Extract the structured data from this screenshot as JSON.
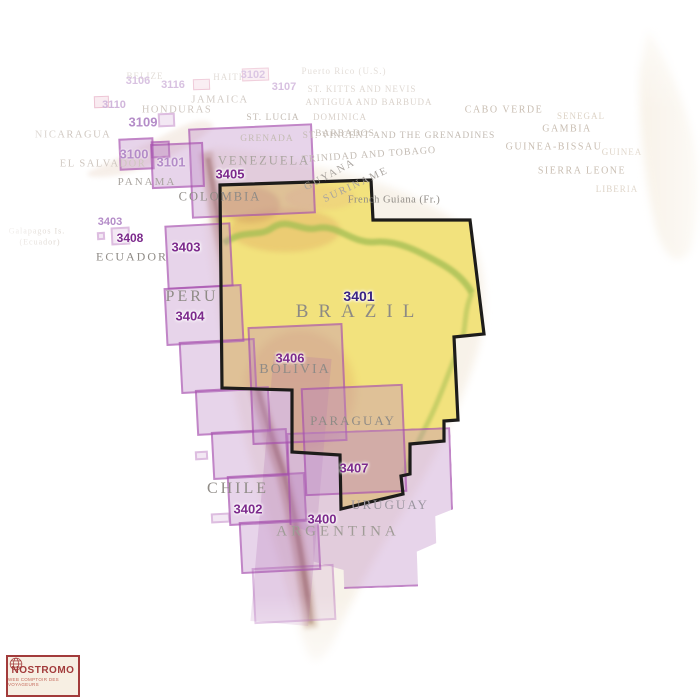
{
  "logo": {
    "name": "NOSTROMO",
    "tagline": "WEB COMPTOIR DES VOYAGEURS"
  },
  "colors": {
    "chart_highlight_yellow": "#f2e27d",
    "chart_outline_black": "#1d1c1a",
    "coverage_box_purple": "#bd87c6",
    "coverage_border_purple": "#a244aa",
    "chart_code_purple": "#7c2a8c",
    "chart_code_dark": "#3a2384",
    "country_label_gray": "#8f8b86",
    "logo_red": "#a23b3b"
  },
  "highlighted_chart": {
    "code": "3401",
    "country": "BRAZIL"
  },
  "boxes": [
    {
      "name": "chart-box-3102",
      "x": 242,
      "y": 68,
      "w": 27,
      "h": 13,
      "rot": -2,
      "cls": "pink"
    },
    {
      "name": "chart-box-3116",
      "x": 193,
      "y": 79,
      "w": 17,
      "h": 11,
      "rot": -2,
      "cls": "pink"
    },
    {
      "name": "chart-box-3110",
      "x": 94,
      "y": 96,
      "w": 15,
      "h": 12,
      "rot": -2,
      "cls": "pink"
    },
    {
      "name": "chart-box-3109",
      "x": 158,
      "y": 113,
      "w": 17,
      "h": 14,
      "rot": -2.5,
      "cls": "faint"
    },
    {
      "name": "chart-box-3405",
      "x": 190,
      "y": 126,
      "w": 124,
      "h": 90,
      "rot": -2.5,
      "cls": ""
    },
    {
      "name": "chart-box-3100",
      "x": 119,
      "y": 138,
      "w": 35,
      "h": 32,
      "rot": -2.5,
      "cls": ""
    },
    {
      "name": "chart-box-3101-small",
      "x": 151,
      "y": 141,
      "w": 19,
      "h": 17,
      "rot": -2.5,
      "cls": ""
    },
    {
      "name": "chart-box-3101",
      "x": 151,
      "y": 143,
      "w": 53,
      "h": 45,
      "rot": -2.5,
      "cls": ""
    },
    {
      "name": "chart-box-3403",
      "x": 166,
      "y": 224,
      "w": 66,
      "h": 64,
      "rot": -3,
      "cls": ""
    },
    {
      "name": "chart-box-3408",
      "x": 111,
      "y": 227,
      "w": 19,
      "h": 18,
      "rot": -3,
      "cls": "faint"
    },
    {
      "name": "chart-box-3408-small",
      "x": 97,
      "y": 232,
      "w": 8,
      "h": 8,
      "rot": -3,
      "cls": "faint"
    },
    {
      "name": "chart-box-3404-seg1",
      "x": 165,
      "y": 286,
      "w": 78,
      "h": 58,
      "rot": -3,
      "cls": ""
    },
    {
      "name": "chart-box-3404-seg2",
      "x": 180,
      "y": 340,
      "w": 76,
      "h": 52,
      "rot": -3,
      "cls": ""
    },
    {
      "name": "chart-box-3402-seg1",
      "x": 196,
      "y": 388,
      "w": 74,
      "h": 46,
      "rot": -3,
      "cls": ""
    },
    {
      "name": "chart-box-3402-seg2",
      "x": 212,
      "y": 430,
      "w": 76,
      "h": 48,
      "rot": -3,
      "cls": ""
    },
    {
      "name": "chart-box-3402-seg3",
      "x": 228,
      "y": 474,
      "w": 78,
      "h": 50,
      "rot": -3,
      "cls": ""
    },
    {
      "name": "chart-box-3402-seg4",
      "x": 240,
      "y": 520,
      "w": 80,
      "h": 52,
      "rot": -3,
      "cls": ""
    },
    {
      "name": "chart-box-3402-seg5",
      "x": 253,
      "y": 566,
      "w": 82,
      "h": 56,
      "rot": -3,
      "cls": "dim"
    },
    {
      "name": "chart-box-andes-core",
      "x": 262,
      "y": 356,
      "w": 58,
      "h": 268,
      "rot": 5,
      "cls": "core"
    },
    {
      "name": "chart-box-island-1",
      "x": 195,
      "y": 451,
      "w": 13,
      "h": 9,
      "rot": -3,
      "cls": "faint"
    },
    {
      "name": "chart-box-island-2",
      "x": 211,
      "y": 513,
      "w": 19,
      "h": 10,
      "rot": -3,
      "cls": "faint"
    },
    {
      "name": "chart-box-3400",
      "x": 289,
      "y": 430,
      "w": 164,
      "h": 158,
      "rot": -2,
      "cls": "steps3400"
    },
    {
      "name": "chart-box-3406",
      "x": 250,
      "y": 325,
      "w": 95,
      "h": 118,
      "rot": -2.5,
      "cls": ""
    },
    {
      "name": "chart-box-3407",
      "x": 303,
      "y": 386,
      "w": 102,
      "h": 108,
      "rot": -2.5,
      "cls": ""
    }
  ],
  "labels": [
    {
      "name": "country-label-belize",
      "text": "BELIZE",
      "x": 145,
      "y": 76,
      "cls": "tiny-faint"
    },
    {
      "name": "country-label-haiti",
      "text": "HAITI",
      "x": 228,
      "y": 77,
      "cls": "tiny-faint"
    },
    {
      "name": "chart-code-3102",
      "text": "3102",
      "x": 253,
      "y": 75,
      "cls": "code code-faint",
      "inter": true
    },
    {
      "name": "country-label-puerto-rico",
      "text": "Puerto Rico (U.S.)",
      "x": 344,
      "y": 71,
      "cls": "tiny-faint"
    },
    {
      "name": "chart-code-3106",
      "text": "3106",
      "x": 138,
      "y": 81,
      "cls": "code code-faint",
      "inter": true
    },
    {
      "name": "chart-code-3116",
      "text": "3116",
      "x": 173,
      "y": 85,
      "cls": "code code-faint",
      "inter": true
    },
    {
      "name": "chart-code-3107",
      "text": "3107",
      "x": 284,
      "y": 87,
      "cls": "code code-faint",
      "inter": true
    },
    {
      "name": "country-label-st-kitts",
      "text": "ST. KITTS AND NEVIS",
      "x": 362,
      "y": 89,
      "cls": "tiny-faint"
    },
    {
      "name": "country-label-antigua",
      "text": "ANTIGUA AND BARBUDA",
      "x": 369,
      "y": 102,
      "cls": "tiny-faint"
    },
    {
      "name": "country-label-jamaica",
      "text": "JAMAICA",
      "x": 220,
      "y": 100,
      "cls": "faint"
    },
    {
      "name": "chart-code-3110",
      "text": "3110",
      "x": 114,
      "y": 105,
      "cls": "code code-faint",
      "inter": true
    },
    {
      "name": "country-label-honduras",
      "text": "HONDURAS",
      "x": 177,
      "y": 110,
      "cls": "faint"
    },
    {
      "name": "country-label-cabo-verde",
      "text": "CABO VERDE",
      "x": 504,
      "y": 110,
      "cls": "afr"
    },
    {
      "name": "country-label-dominica",
      "text": "DOMINICA",
      "x": 340,
      "y": 117,
      "cls": "tiny-faint"
    },
    {
      "name": "country-label-senegal",
      "text": "SENEGAL",
      "x": 581,
      "y": 116,
      "cls": "afr-faint"
    },
    {
      "name": "country-label-st-lucia",
      "text": "ST. LUCIA",
      "x": 273,
      "y": 118,
      "cls": "tiny"
    },
    {
      "name": "chart-code-3109",
      "text": "3109",
      "x": 143,
      "y": 122,
      "cls": "code code-mid",
      "inter": true
    },
    {
      "name": "country-label-gambia",
      "text": "GAMBIA",
      "x": 567,
      "y": 129,
      "cls": "afr"
    },
    {
      "name": "country-label-nicaragua",
      "text": "NICARAGUA",
      "x": 73,
      "y": 135,
      "cls": "faint"
    },
    {
      "name": "country-label-grenada",
      "text": "GRENADA",
      "x": 267,
      "y": 139,
      "cls": "tiny"
    },
    {
      "name": "country-label-barbados",
      "text": "BARBADOS",
      "x": 345,
      "y": 134,
      "cls": "tiny"
    },
    {
      "name": "country-label-st-vincent",
      "text": "ST. VINCENT AND THE GRENADINES",
      "x": 399,
      "y": 136,
      "cls": "tiny"
    },
    {
      "name": "country-label-guinea-bissau",
      "text": "GUINEA-BISSAU",
      "x": 554,
      "y": 147,
      "cls": "afr"
    },
    {
      "name": "country-label-guinea",
      "text": "GUINEA",
      "x": 622,
      "y": 152,
      "cls": "afr-faint"
    },
    {
      "name": "chart-code-3100",
      "text": "3100",
      "x": 134,
      "y": 154,
      "cls": "code code-mid",
      "inter": true
    },
    {
      "name": "country-label-trinidad",
      "text": "TRINIDAD AND TOBAGO",
      "x": 369,
      "y": 155,
      "cls": "tiny",
      "rot": -4,
      "fs": 10
    },
    {
      "name": "chart-code-3101",
      "text": "3101",
      "x": 171,
      "y": 162,
      "cls": "code code-mid",
      "inter": true
    },
    {
      "name": "country-label-el-salvador",
      "text": "EL SALVADOR",
      "x": 103,
      "y": 164,
      "cls": "faint"
    },
    {
      "name": "country-label-venezuela",
      "text": "VENEZUELA",
      "x": 264,
      "y": 161,
      "cls": "mid",
      "fs": 12.5
    },
    {
      "name": "country-label-sierra-leone",
      "text": "SIERRA LEONE",
      "x": 582,
      "y": 171,
      "cls": "afr"
    },
    {
      "name": "chart-code-3405",
      "text": "3405",
      "x": 230,
      "y": 174,
      "cls": "code",
      "inter": true
    },
    {
      "name": "country-label-guyana",
      "text": "GUYANA",
      "x": 330,
      "y": 175,
      "cls": "mid",
      "rot": -28,
      "fs": 10.5
    },
    {
      "name": "country-label-panama",
      "text": "PANAMA",
      "x": 147,
      "y": 182,
      "cls": "mid",
      "fs": 11
    },
    {
      "name": "country-label-suriname",
      "text": "SURINAME",
      "x": 356,
      "y": 185,
      "cls": "mid",
      "rot": -25,
      "fs": 10.5
    },
    {
      "name": "country-label-liberia",
      "text": "LIBERIA",
      "x": 617,
      "y": 189,
      "cls": "afr-faint"
    },
    {
      "name": "country-label-french-guiana",
      "text": "French Guiana (Fr.)",
      "x": 394,
      "y": 200,
      "cls": "frg"
    },
    {
      "name": "country-label-colombia",
      "text": "COLOMBIA",
      "x": 220,
      "y": 197,
      "cls": "main",
      "fs": 12.5
    },
    {
      "name": "chart-code-3403-small",
      "text": "3403",
      "x": 110,
      "y": 222,
      "cls": "code code-mid",
      "fs": 11,
      "inter": true
    },
    {
      "name": "country-label-galapagos",
      "text": "Galapagos Is.",
      "x": 37,
      "y": 231,
      "cls": "tiny-faint",
      "fs": 8
    },
    {
      "name": "country-label-galapagos-2",
      "text": "(Ecuador)",
      "x": 40,
      "y": 242,
      "cls": "tiny-faint",
      "fs": 8
    },
    {
      "name": "chart-code-3408",
      "text": "3408",
      "x": 130,
      "y": 238,
      "cls": "code",
      "fs": 12,
      "inter": true
    },
    {
      "name": "chart-code-3403",
      "text": "3403",
      "x": 186,
      "y": 247,
      "cls": "code",
      "inter": true
    },
    {
      "name": "country-label-ecuador",
      "text": "ECUADOR",
      "x": 132,
      "y": 257,
      "cls": "main",
      "fs": 12
    },
    {
      "name": "chart-code-3401",
      "text": "3401",
      "x": 359,
      "y": 296,
      "cls": "code code-dark",
      "inter": true
    },
    {
      "name": "country-label-peru",
      "text": "PERU",
      "x": 192,
      "y": 297,
      "cls": "big",
      "fs": 16
    },
    {
      "name": "chart-code-3404",
      "text": "3404",
      "x": 190,
      "y": 316,
      "cls": "code",
      "inter": true
    },
    {
      "name": "country-label-brazil",
      "text": "BRAZIL",
      "x": 360,
      "y": 312,
      "cls": "brazil"
    },
    {
      "name": "chart-code-3406",
      "text": "3406",
      "x": 290,
      "y": 358,
      "cls": "code",
      "inter": true
    },
    {
      "name": "country-label-bolivia",
      "text": "BOLIVIA",
      "x": 295,
      "y": 370,
      "cls": "main",
      "fs": 14
    },
    {
      "name": "country-label-paraguay",
      "text": "PARAGUAY",
      "x": 353,
      "y": 421,
      "cls": "main"
    },
    {
      "name": "chart-code-3407",
      "text": "3407",
      "x": 354,
      "y": 468,
      "cls": "code",
      "inter": true
    },
    {
      "name": "country-label-chile",
      "text": "CHILE",
      "x": 238,
      "y": 489,
      "cls": "big"
    },
    {
      "name": "country-label-uruguay",
      "text": "URUGUAY",
      "x": 390,
      "y": 505,
      "cls": "main uru"
    },
    {
      "name": "chart-code-3402",
      "text": "3402",
      "x": 248,
      "y": 509,
      "cls": "code",
      "inter": true
    },
    {
      "name": "chart-code-3400",
      "text": "3400",
      "x": 322,
      "y": 519,
      "cls": "code",
      "inter": true
    },
    {
      "name": "country-label-argentina",
      "text": "ARGENTINA",
      "x": 338,
      "y": 532,
      "cls": "argen"
    }
  ]
}
